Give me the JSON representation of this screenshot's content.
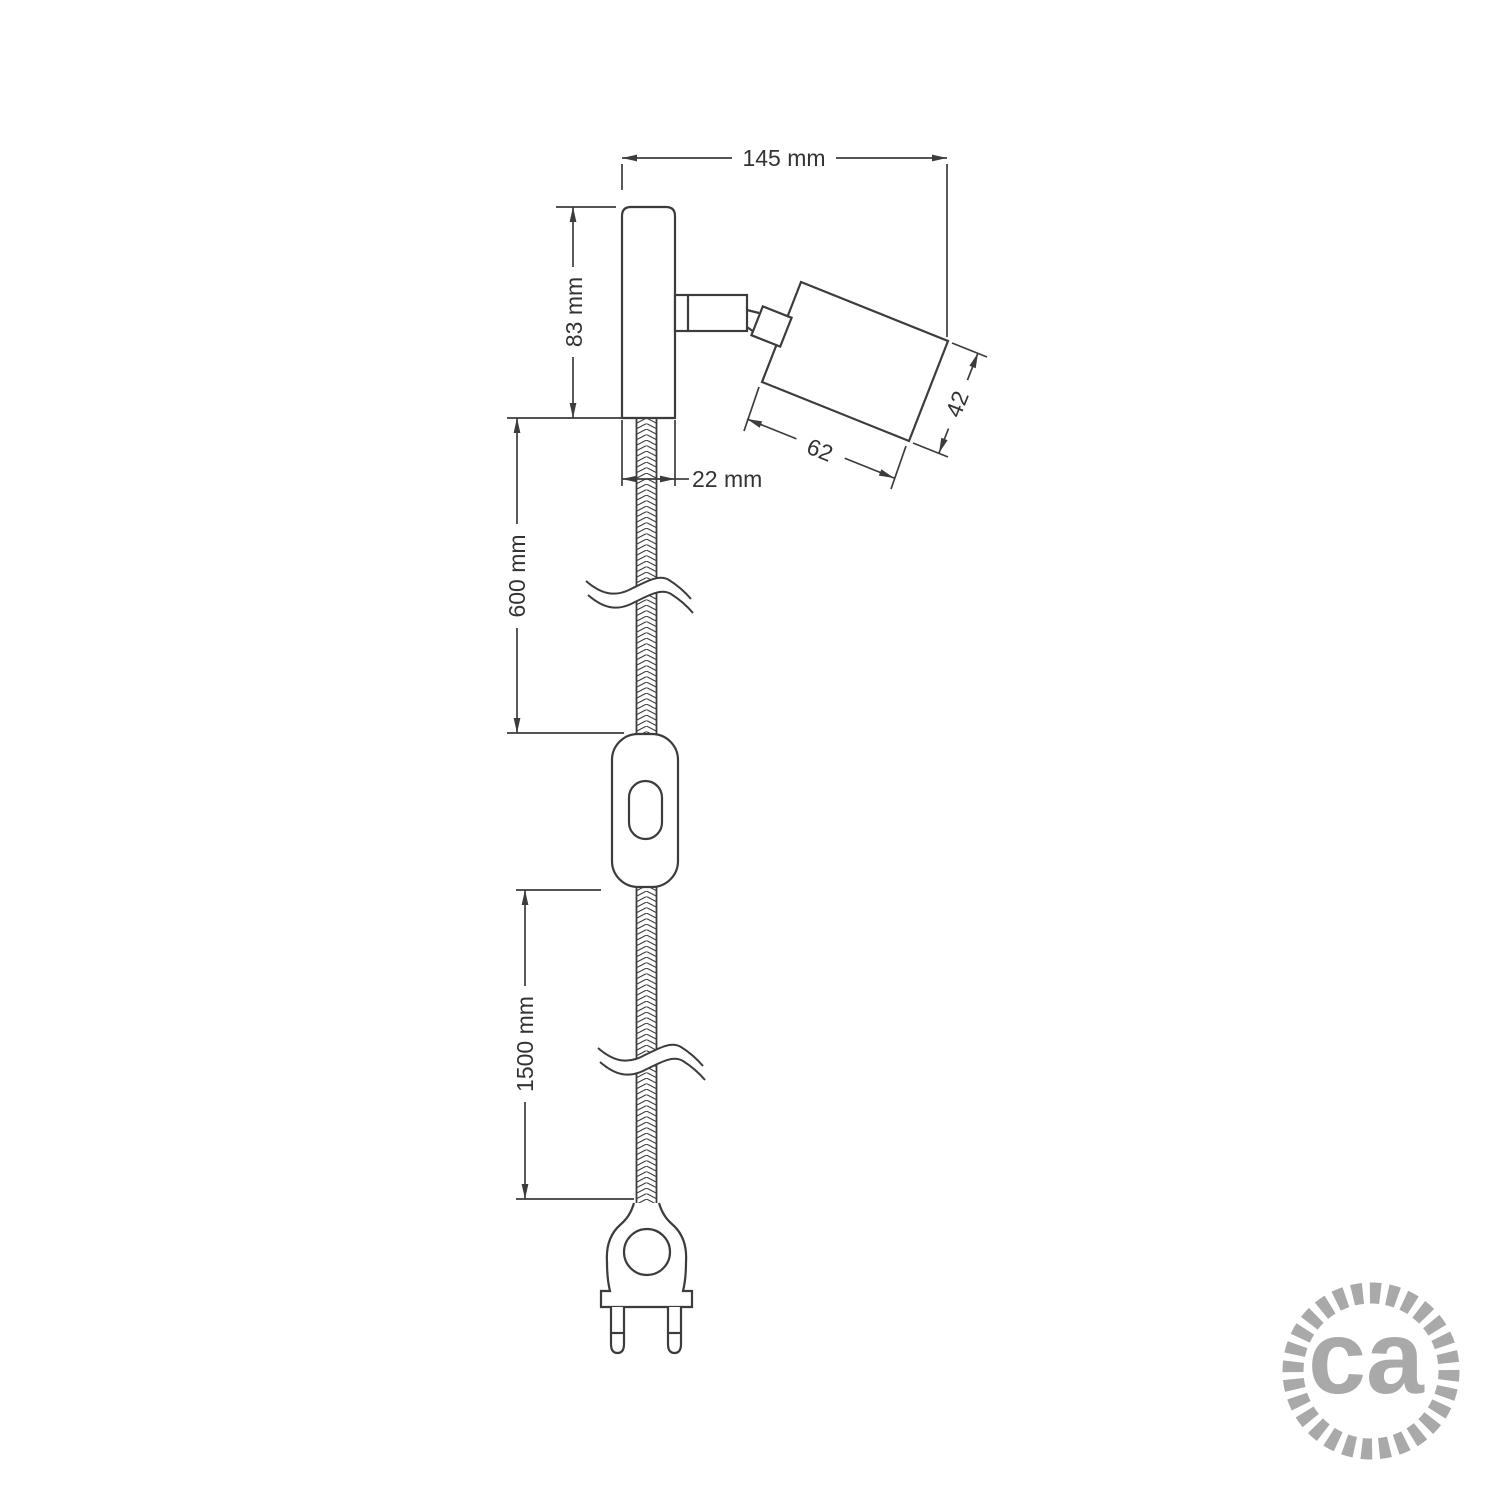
{
  "page": {
    "background": "#ffffff"
  },
  "drawing": {
    "line_color": "#3c3c3c",
    "labels": {
      "overall_width": "145 mm",
      "plate_height": "83 mm",
      "plate_width": "22 mm",
      "cable_upper_length": "600 mm",
      "cable_lower_length": "1500 mm",
      "spotlight_length": "62",
      "spotlight_diameter": "42"
    }
  },
  "logo": {
    "text": "ca",
    "color": "#a9a9a9"
  }
}
